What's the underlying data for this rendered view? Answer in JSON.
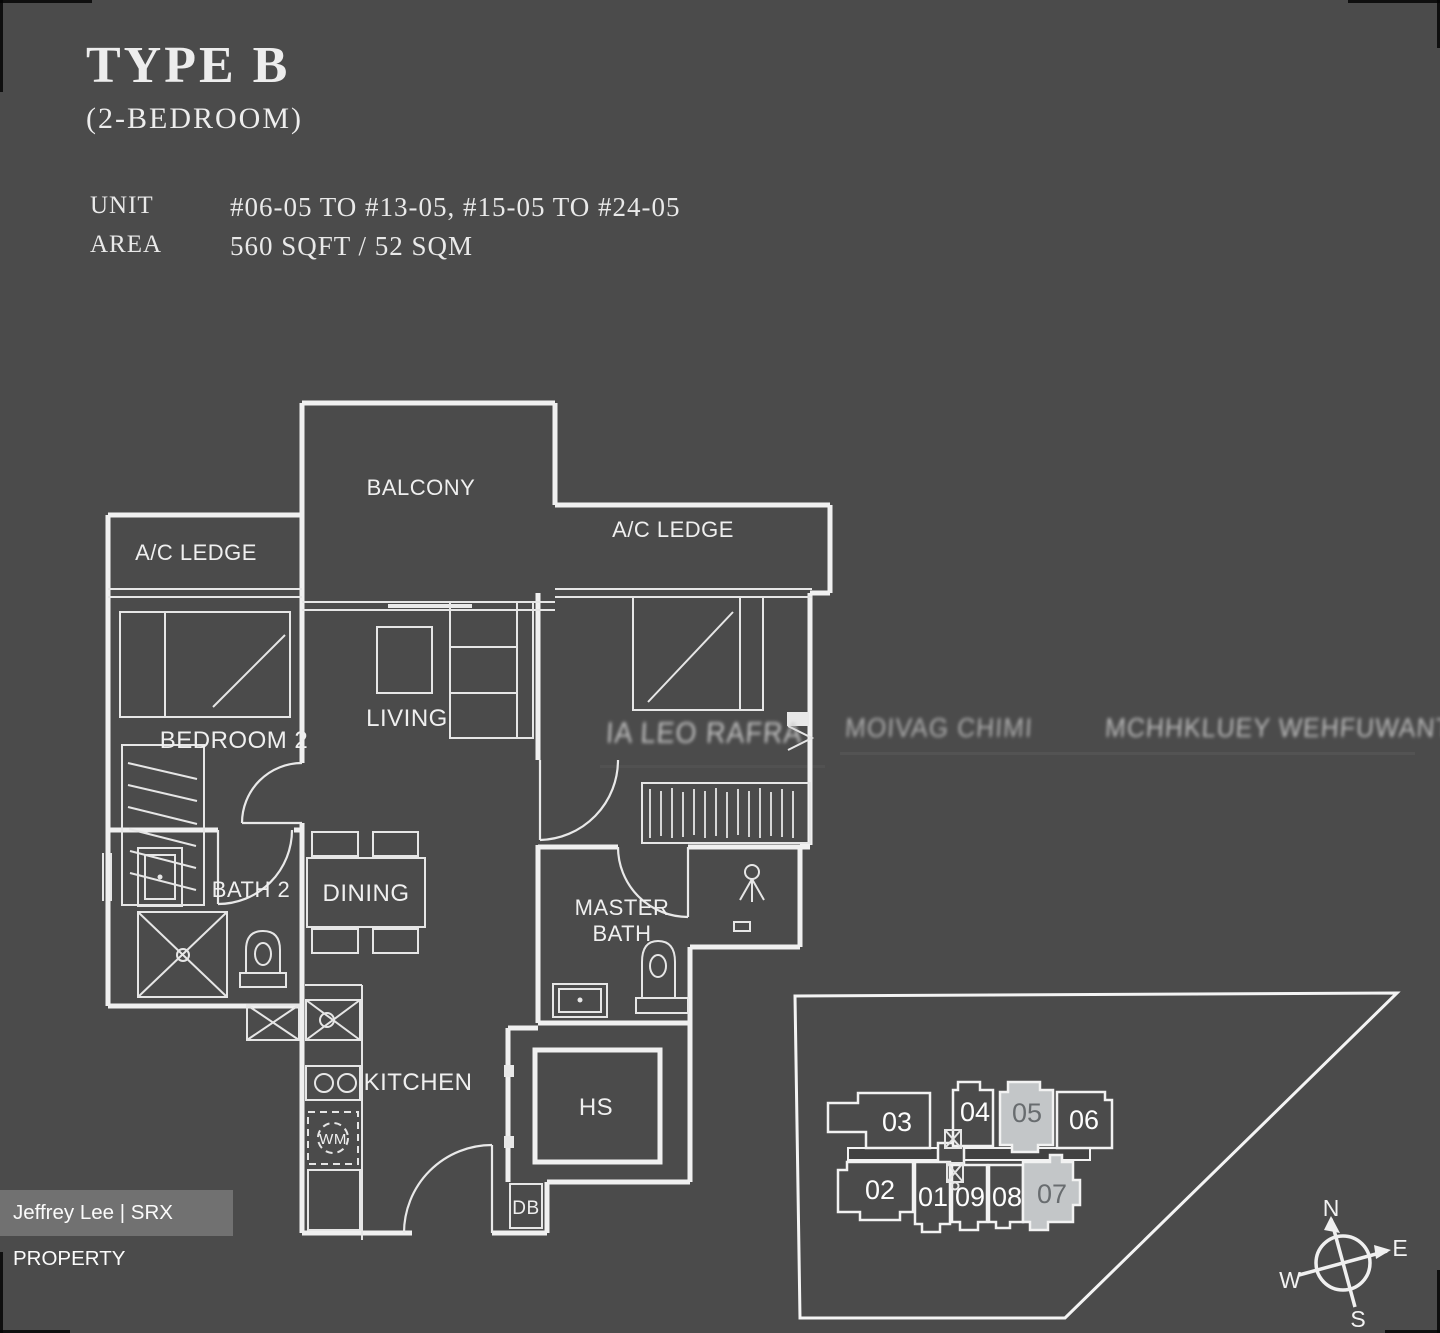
{
  "page": {
    "background": "#4b4b4b",
    "line_color": "#f0f0f0",
    "highlight_fill": "#c3c6c8",
    "watermark_bg": "#717171"
  },
  "header": {
    "title": "TYPE B",
    "subtitle": "(2-BEDROOM)",
    "unit_label": "UNIT",
    "unit_value": "#06-05 TO #13-05, #15-05 TO #24-05",
    "area_label": "AREA",
    "area_value": "560 SQFT / 52 SQM"
  },
  "floorplan": {
    "labels": {
      "balcony": "BALCONY",
      "ac_ledge_left": "A/C LEDGE",
      "ac_ledge_right": "A/C LEDGE",
      "bedroom2": "BEDROOM 2",
      "living": "LIVING",
      "dining": "DINING",
      "bath2": "BATH 2",
      "master_bath_line1": "MASTER",
      "master_bath_line2": "BATH",
      "kitchen": "KITCHEN",
      "household_shelter": "HS",
      "washing_machine": "WM",
      "distribution_board": "DB"
    },
    "distorted_watermark_remnants": {
      "master_bedroom_label": "IA LEO RAFRA",
      "remnant_center": "MOIVAG CHIMI",
      "remnant_right": "MCHHKLUEY WEHFUWANT"
    }
  },
  "siteplan": {
    "units": [
      {
        "label": "03",
        "highlighted": false
      },
      {
        "label": "04",
        "highlighted": false
      },
      {
        "label": "05",
        "highlighted": true
      },
      {
        "label": "06",
        "highlighted": false
      },
      {
        "label": "02",
        "highlighted": false
      },
      {
        "label": "01",
        "highlighted": false
      },
      {
        "label": "09",
        "highlighted": false
      },
      {
        "label": "08",
        "highlighted": false
      },
      {
        "label": "07",
        "highlighted": true
      }
    ],
    "compass": {
      "north": "N",
      "east": "E",
      "south": "S",
      "west": "W"
    }
  },
  "watermark": {
    "text": "Jeffrey Lee | SRX PROPERTY"
  }
}
